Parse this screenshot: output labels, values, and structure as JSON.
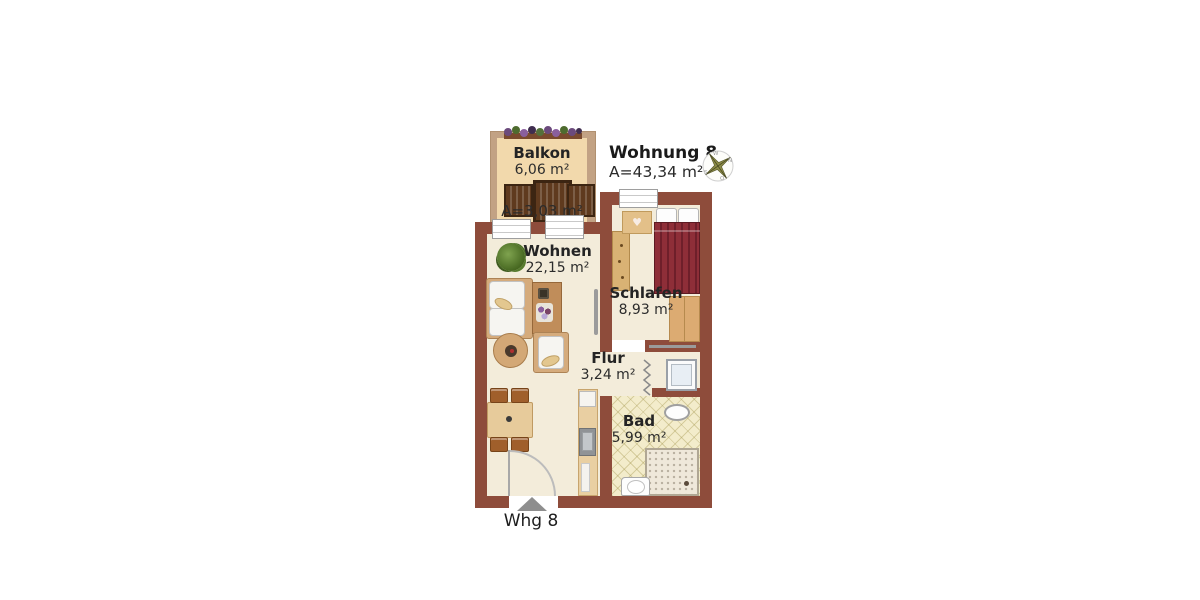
{
  "title": {
    "name": "Wohnung 8",
    "area": "A=43,34 m²"
  },
  "rooms": {
    "balkon": {
      "name": "Balkon",
      "area": "6,06 m²",
      "area_counted": "A=3,03 m²"
    },
    "wohnen": {
      "name": "Wohnen",
      "area": "22,15 m²"
    },
    "schlafen": {
      "name": "Schlafen",
      "area": "8,93 m²"
    },
    "flur": {
      "name": "Flur",
      "area": "3,24 m²"
    },
    "bad": {
      "name": "Bad",
      "area": "5,99 m²"
    }
  },
  "entrance": {
    "label": "Whg 8"
  },
  "compass": {
    "top": "W",
    "right": "N",
    "bottom": "O",
    "left": "S"
  },
  "icons": {
    "nightstand_heart": "♥"
  },
  "colors": {
    "wall": "#8e4c3b",
    "floor": "#f3ecda",
    "balcony_wall": "#c2a284",
    "balcony_floor": "#f2d9ac",
    "bath_tile": "#f3eccb",
    "bed_cover": "#8e2e38",
    "wood_furniture": "#d9b274",
    "label_text": "#242424"
  }
}
